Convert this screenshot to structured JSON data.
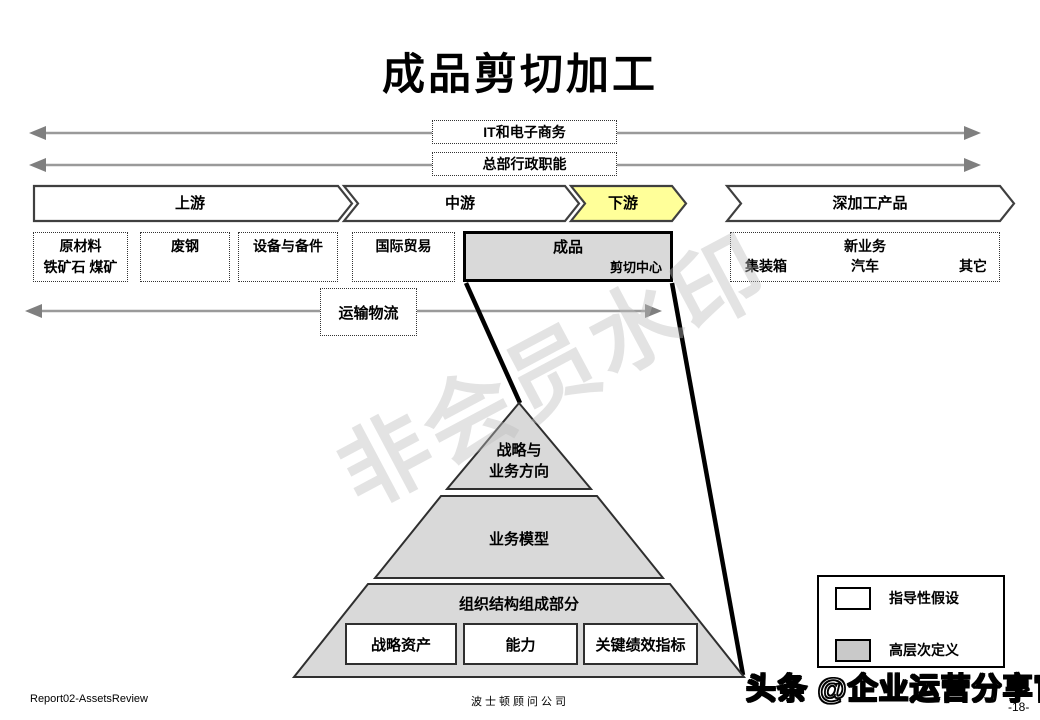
{
  "title": "成品剪切加工",
  "top_arrows": {
    "arrow1_label": "IT和电子商务",
    "arrow2_label": "总部行政职能"
  },
  "chevrons": {
    "upstream": "上游",
    "midstream": "中游",
    "downstream": "下游",
    "deep_processing": "深加工产品"
  },
  "upstream_boxes": {
    "raw_materials_line1": "原材料",
    "raw_materials_line2": "铁矿石  煤矿",
    "scrap_steel": "废钢",
    "equipment_parts": "设备与备件",
    "intl_trade": "国际贸易"
  },
  "product_box": {
    "title": "成品",
    "subtitle": "剪切中心"
  },
  "new_business_box": {
    "left": "集装箱",
    "center_top": "新业务",
    "center_bottom": "汽车",
    "right": "其它"
  },
  "logistics_label": "运输物流",
  "pyramid": {
    "tier1_line1": "战略与",
    "tier1_line2": "业务方向",
    "tier2": "业务模型",
    "tier3_title": "组织结构组成部分",
    "tier3_boxes": [
      "战略资产",
      "能力",
      "关键绩效指标"
    ]
  },
  "legend": {
    "item1_label": "指导性假设",
    "item1_color": "#ffffff",
    "item2_label": "高层次定义",
    "item2_color": "#c9c9c9"
  },
  "watermarks": {
    "center": "非会员水印",
    "bottom_right": "头条 @企业运营分享官"
  },
  "footer": {
    "left": "Report02-AssetsReview",
    "center": "波士顿顾问公司",
    "page": "-18-"
  },
  "colors": {
    "downstream_highlight": "#ffff99",
    "gray_fill": "#d9d9d9",
    "arrow_gray": "#8c8c8c"
  }
}
